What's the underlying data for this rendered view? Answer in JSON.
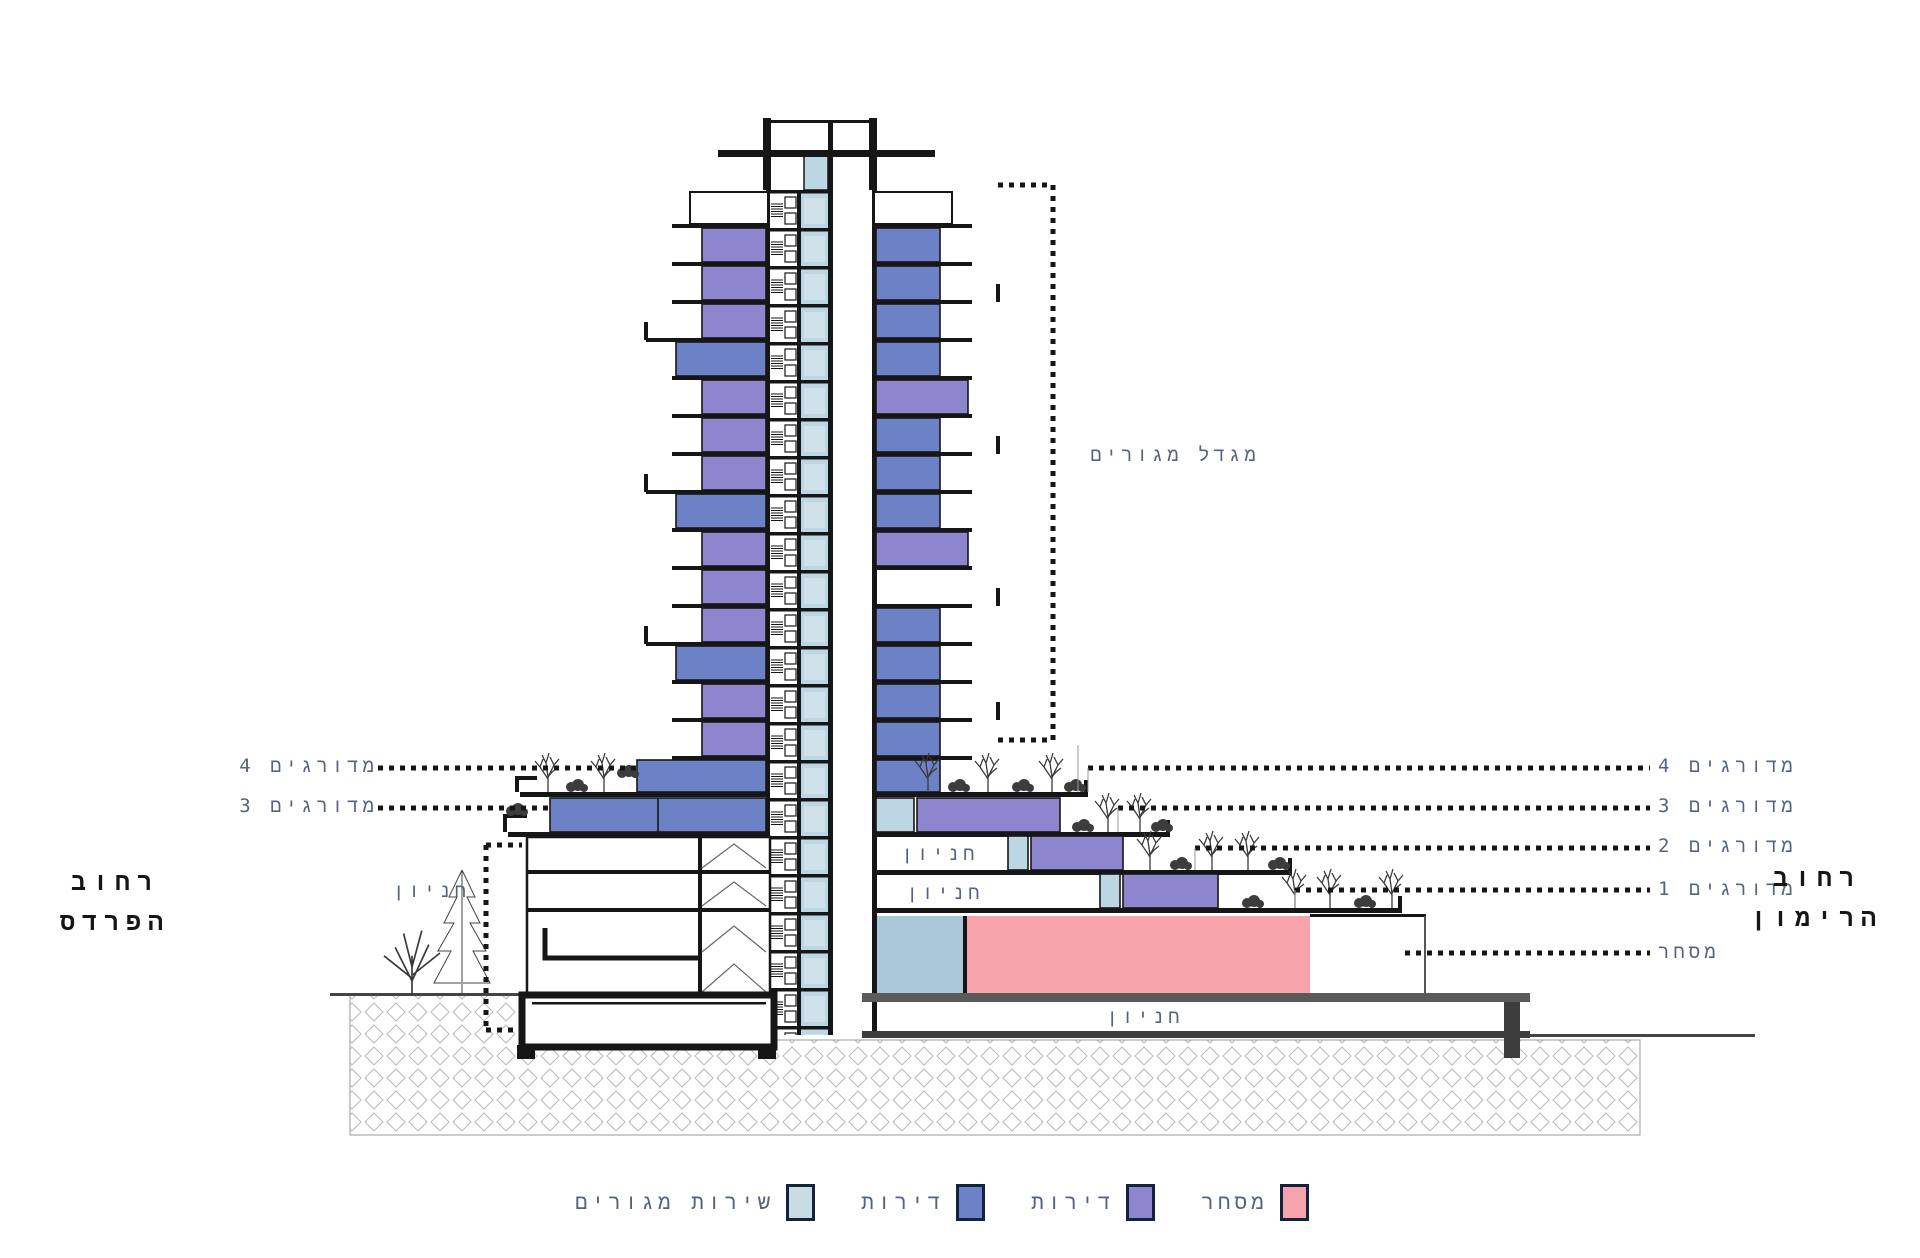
{
  "drawing": {
    "tower_label": "מגדל מגורים",
    "parking_label": "חניון"
  },
  "left_annotations": {
    "terraced_4": "מדורגים 4",
    "terraced_3": "מדורגים 3",
    "parking": "חניון",
    "street": {
      "line1": "רחוב",
      "line2": "הפרדס"
    }
  },
  "right_annotations": {
    "terraced_4": "מדורגים 4",
    "terraced_3": "מדורגים 3",
    "terraced_2": "מדורגים 2",
    "terraced_1": "מדורגים 1",
    "commerce": "מסחר",
    "street": {
      "line1": "רחוב",
      "line2": "הרימון"
    }
  },
  "legend": {
    "items": [
      {
        "label": "שירות מגורים",
        "color": "#c9dce3"
      },
      {
        "label": "דירות",
        "color": "#6d81c6"
      },
      {
        "label": "דירות",
        "color": "#8d86ce"
      },
      {
        "label": "מסחר",
        "color": "#f6a3ab"
      }
    ]
  },
  "colors": {
    "apartments_blue": "#6d81c6",
    "apartments_purple": "#8d86ce",
    "residential_services_lightblue": "#bdd6e4",
    "commerce_pink": "#f6a3ab",
    "annotation_text": "#55637f",
    "linework": "#161616"
  }
}
